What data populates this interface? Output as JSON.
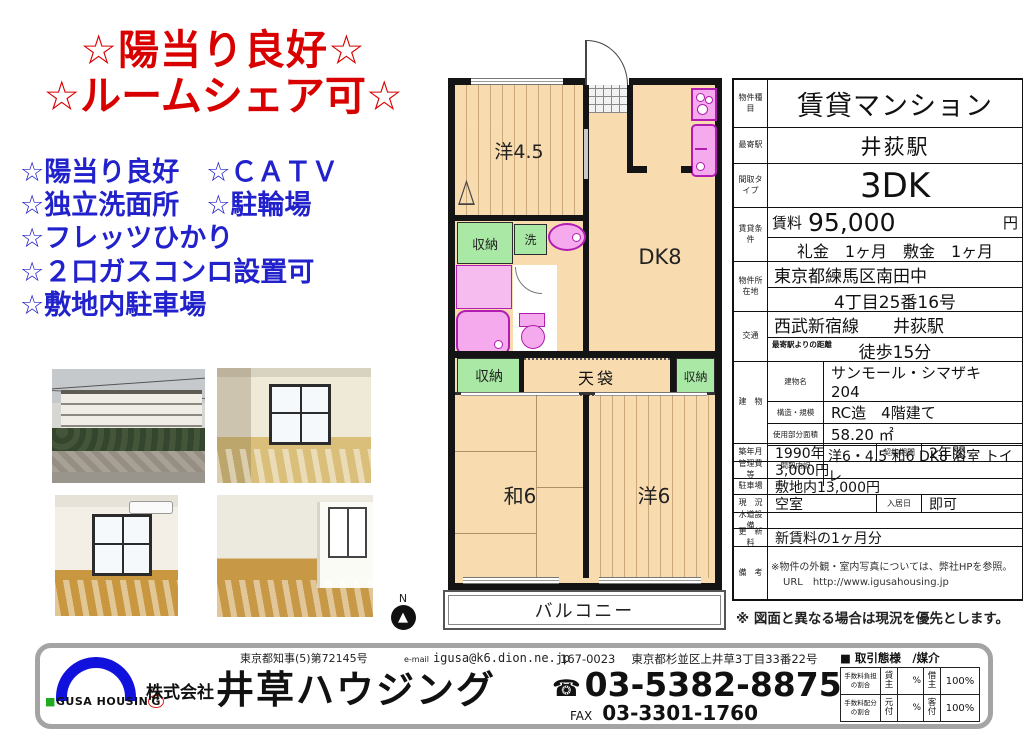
{
  "headline": {
    "line1": "☆陽当り良好☆",
    "line2": "☆ルームシェア可☆"
  },
  "features": [
    "☆陽当り良好　☆ＣＡＴＶ",
    "☆独立洗面所　☆駐輪場",
    "☆フレッツひかり",
    "☆２口ガスコンロ設置可",
    "☆敷地内駐車場"
  ],
  "colors": {
    "headline_red": "#d90000",
    "feature_blue": "#2222cc",
    "plan_floor": "#f8dcb0",
    "plan_closet_green": "#a9e9a5",
    "plan_fixture_pink": "#f4aaec",
    "plan_fixture_border": "#b21cb2",
    "logo_blue": "#1111dd",
    "logo_green": "#22aa22"
  },
  "floorplan": {
    "north": "N",
    "yo45": "洋4.5",
    "dk": "DK8",
    "closet1": "収納",
    "wash": "洗",
    "tenbukuro": "天袋",
    "closet2": "収納",
    "closet3": "収納",
    "wa6": "和6",
    "yo6": "洋6",
    "balcony": "バルコニー"
  },
  "spec": {
    "type_label": "物件種目",
    "type": "賃貸マンション",
    "station_label": "最寄駅",
    "station": "井荻駅",
    "layout_label": "間取タイプ",
    "layout": "3DK",
    "terms_label": "賃貸条件",
    "rent_label": "賃料",
    "rent": "95,000",
    "rent_unit": "円",
    "deposit_line": "礼金　1ヶ月　敷金　1ヶ月",
    "address_label": "物件所在地",
    "address1": "東京都練馬区南田中",
    "address2": "4丁目25番16号",
    "access_label": "交通",
    "access_line": "西武新宿線　　井荻駅",
    "access_sub": "最寄駅よりの距離",
    "walk": "徒歩15分",
    "building_label": "建　物",
    "bname_label": "建物名",
    "bname": "サンモール・シマザキ　204",
    "structure_label": "構造・規模",
    "structure": "RC造　4階建て",
    "area_label": "使用部分面積",
    "area": "58.20 ㎡",
    "madori_label": "間取内訳",
    "madori": "洋6・4.5 和6 DK8 浴室 トイレ",
    "built_label": "築年月",
    "built": "1990年",
    "term_label": "契約期間",
    "term": "2年間",
    "fee_label": "管理費等",
    "fee": "3,000円",
    "parking_label": "駐車場",
    "parking": "敷地内13,000円",
    "status_label": "現　況",
    "status": "空室",
    "movein_label": "入居日",
    "movein": "即可",
    "equip_label": "水道設備",
    "equip": "",
    "renewal_label": "更　新　料",
    "renewal": "新賃料の1ヶ月分",
    "notes_label": "備　考",
    "notes1": "※物件の外観・室内写真については、弊社HPを参照。",
    "notes2": "URL　http://www.igusahousing.jp"
  },
  "notice": {
    "text": "※ 図面と異なる場合は現況を優先とします。"
  },
  "footer": {
    "license": "東京都知事(5)第72145号",
    "email_label": "e-mail",
    "email": "igusa@k6.dion.ne.jp",
    "postal": "167-0023",
    "address": "東京都杉並区上井草3丁目33番22号",
    "company_prefix": "株式会社",
    "company": "井草ハウジング",
    "phone_icon": "☎",
    "phone": "03-5382-8875",
    "fax_label": "FAX",
    "fax": "03-3301-1760",
    "logo_square": "■",
    "logo_text": "GUSA HOUSIN",
    "logo_g": "G",
    "deal_header": "■ 取引態様　/媒介",
    "deal": {
      "r1_label": "手数料負担の割合",
      "r1_c1": "貸主",
      "r1_c2": "%",
      "r1_c3": "借主",
      "r1_c4": "100%",
      "r2_label": "手数料配分の割合",
      "r2_c1": "元付",
      "r2_c2": "%",
      "r2_c3": "客付",
      "r2_c4": "100%"
    }
  }
}
